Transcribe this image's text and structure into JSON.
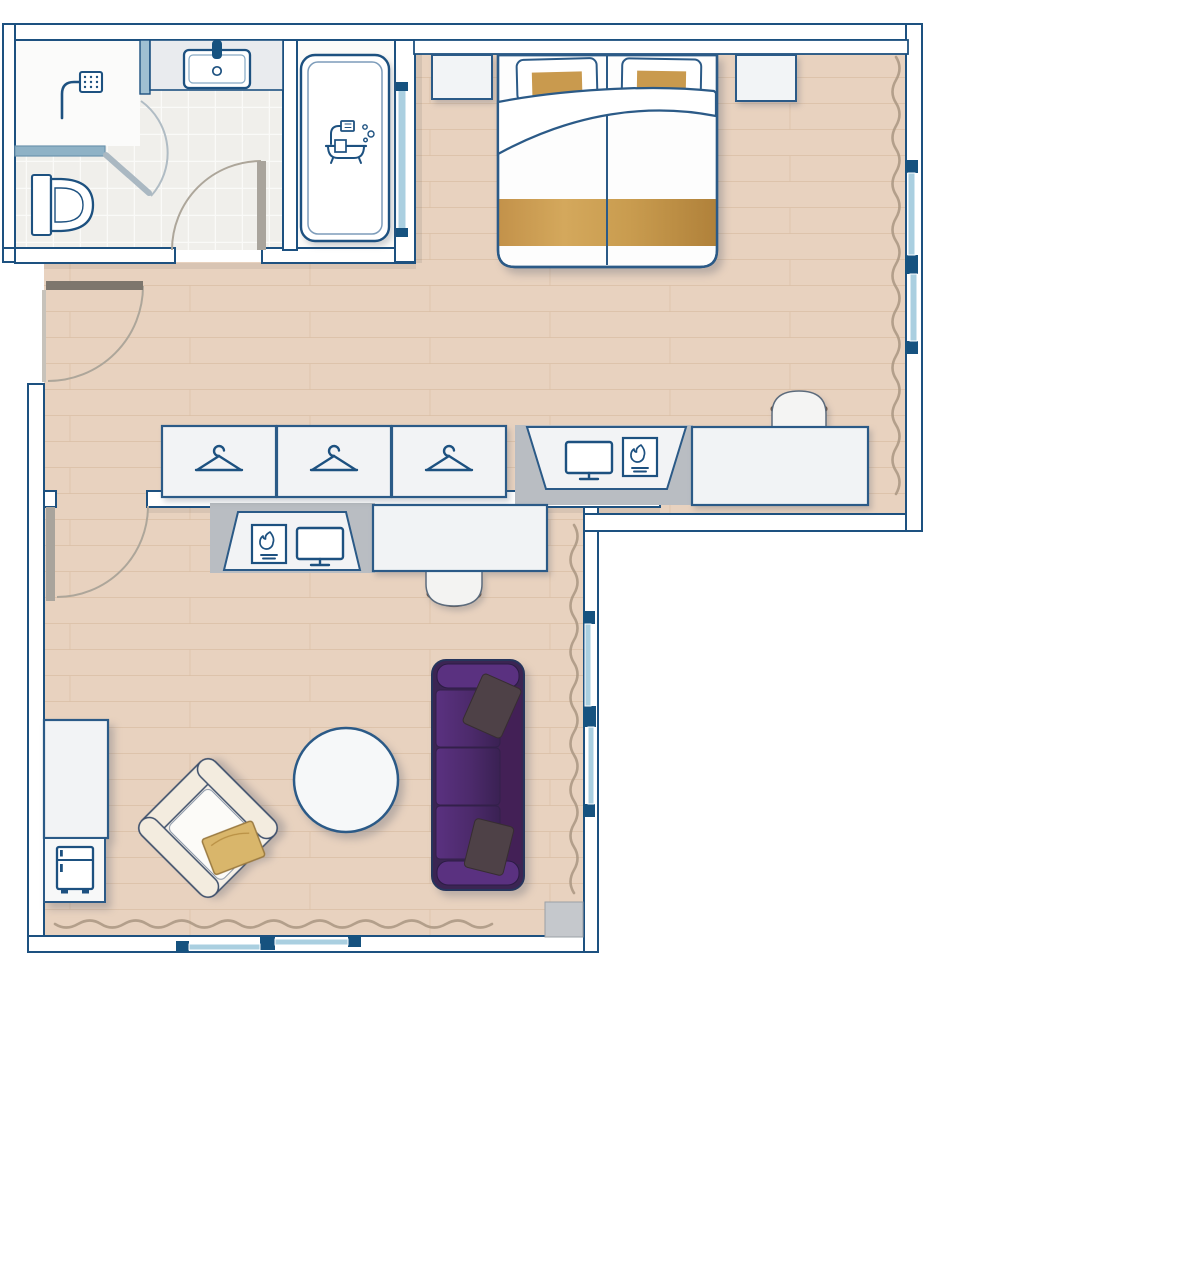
{
  "title": "hotel-suite-floor-plan",
  "palette": {
    "outline": "#1d5180",
    "furn": "#2b5a87",
    "wall": "#ffffff",
    "wood": "#e8d2bf",
    "wood_line": "#d8bca2",
    "tile": "#f0efeb",
    "tile_line": "#fafaf8",
    "glass": "#aacfe0",
    "glass_dark": "#16527f",
    "gray": "#b9bdc2",
    "gold": "#c99a4e",
    "gold_dark": "#b0813a",
    "purple": "#4e2a6d",
    "purple_dark": "#3b2553",
    "purple_arm": "#5a3180",
    "pillow_dark": "#4e4147",
    "cream": "#f6f1e8",
    "chair_brown": "#6a5242",
    "curtain": "#a99781",
    "door_leaf": "#a9a49c",
    "arc": "#ada69a"
  },
  "rooms": [
    {
      "name": "bathroom",
      "features": [
        "shower",
        "sink-vanity",
        "toilet",
        "door-swing"
      ]
    },
    {
      "name": "bathtub-room",
      "features": [
        "bathtub",
        "glass-panel"
      ]
    },
    {
      "name": "bedroom",
      "features": [
        "double-bed",
        "pillow-left",
        "pillow-right",
        "duvet",
        "gold-runner",
        "nightstand-left",
        "nightstand-right",
        "desk",
        "desk-chair",
        "tv-fireplace-niche",
        "curtain",
        "windows"
      ]
    },
    {
      "name": "hallway",
      "features": [
        "entrance-door",
        "bathroom-door",
        "living-room-door"
      ]
    },
    {
      "name": "living-room",
      "features": [
        "sofa",
        "armchair",
        "coffee-table",
        "desk",
        "desk-chair",
        "tv-fireplace-niche",
        "minibar-cabinet",
        "curtains",
        "windows"
      ]
    },
    {
      "name": "wardrobe-wall",
      "features": [
        "wardrobe-unit",
        "wardrobe-unit",
        "wardrobe-unit"
      ]
    }
  ],
  "icons": [
    {
      "name": "hanger-icon",
      "count": 3
    },
    {
      "name": "tv-icon",
      "count": 2
    },
    {
      "name": "fireplace-icon",
      "count": 2
    },
    {
      "name": "shower-icon",
      "count": 1
    },
    {
      "name": "bathtub-icon",
      "count": 1
    },
    {
      "name": "sink-icon",
      "count": 1
    },
    {
      "name": "toilet-icon",
      "count": 1
    },
    {
      "name": "minibar-icon",
      "count": 1
    }
  ],
  "counts": {
    "windows_bedroom": 2,
    "windows_living_side": 2,
    "windows_living_bottom": 2,
    "doors": 4,
    "sofa_seats": 3
  }
}
